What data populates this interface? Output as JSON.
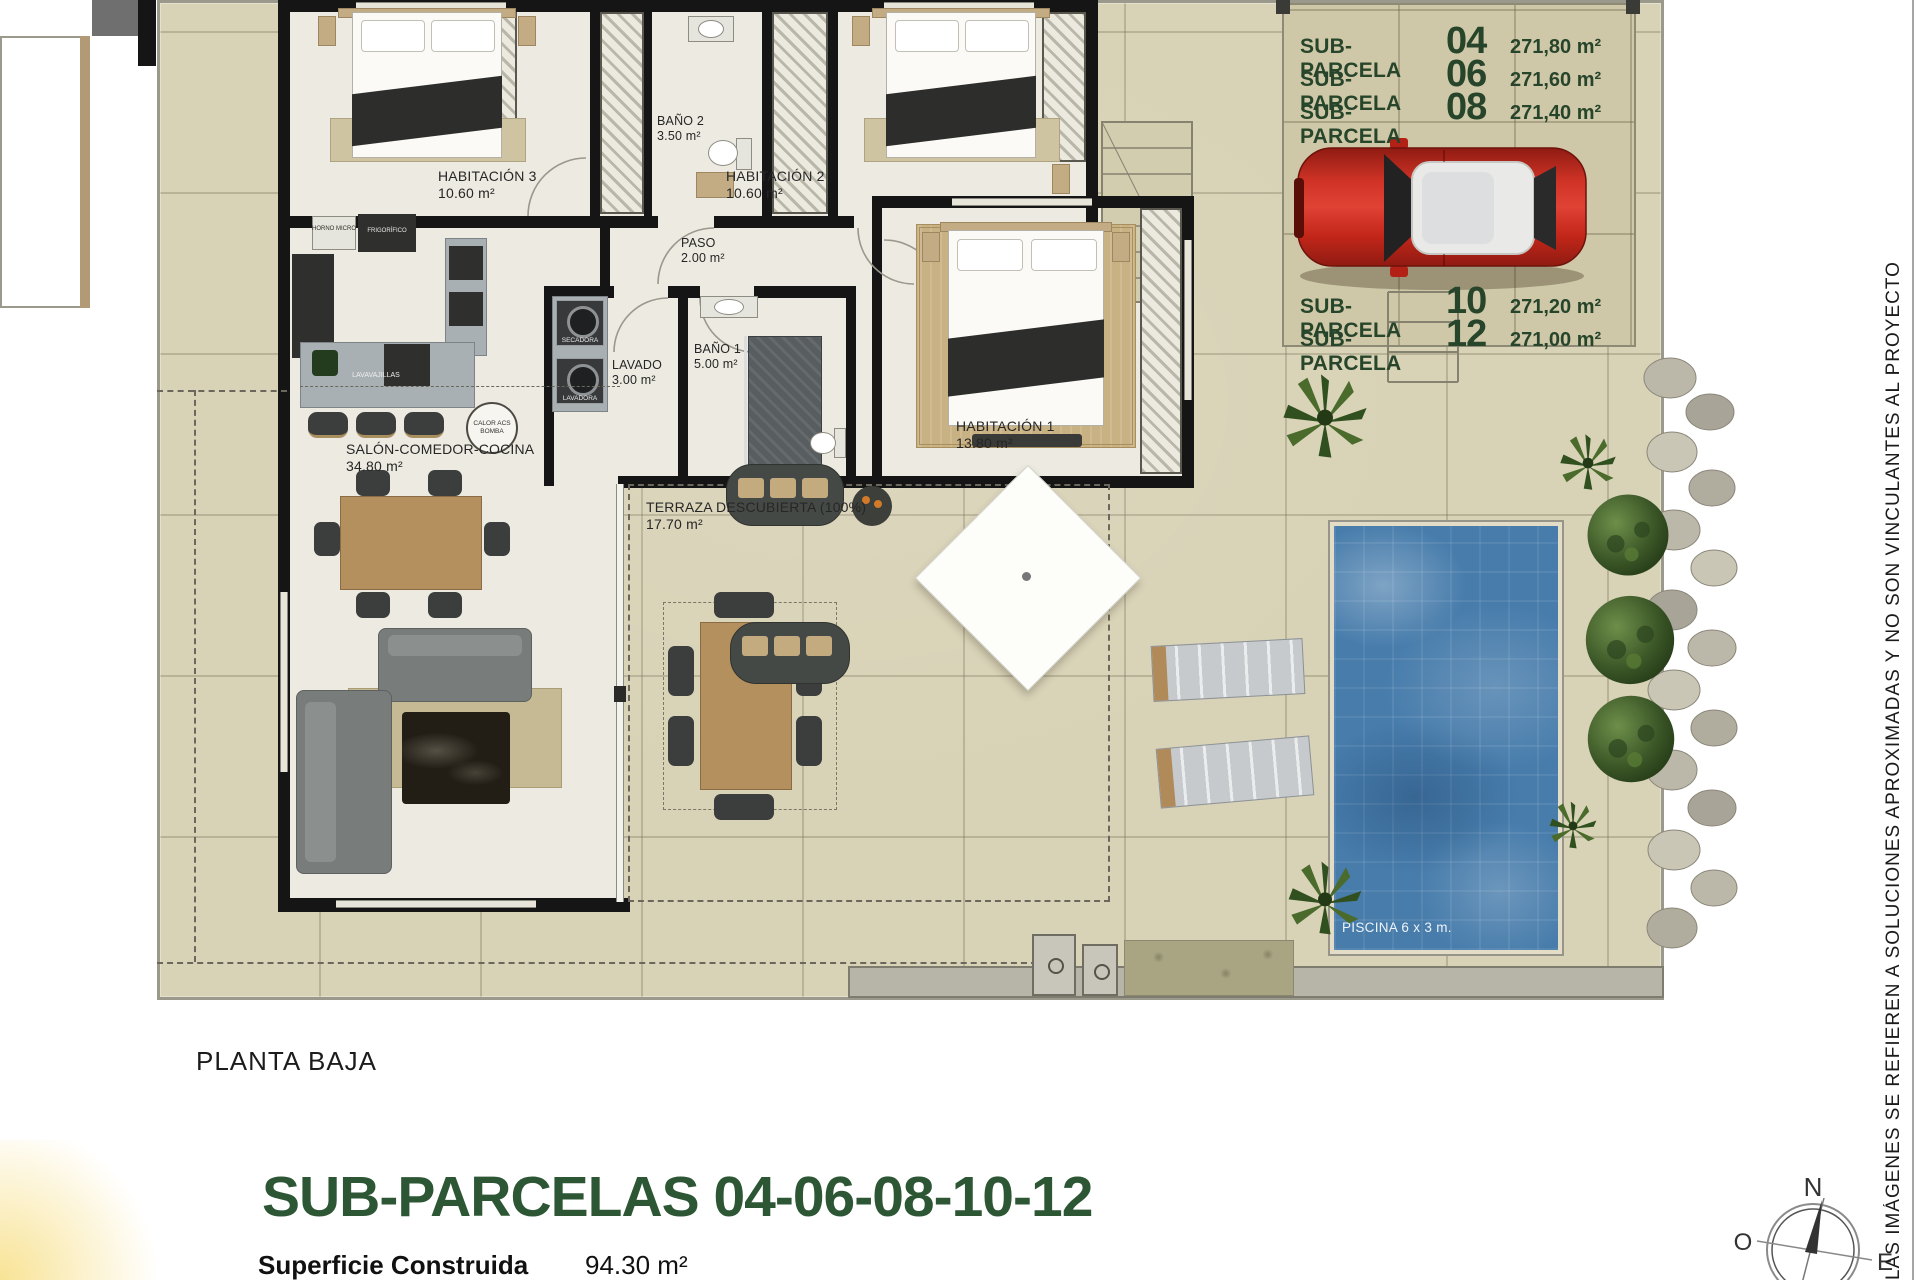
{
  "sub_parcelas": [
    {
      "label": "SUB-PARCELA",
      "num": "04",
      "area": "271,80 m²"
    },
    {
      "label": "SUB-PARCELA",
      "num": "06",
      "area": "271,60 m²"
    },
    {
      "label": "SUB-PARCELA",
      "num": "08",
      "area": "271,40 m²"
    },
    {
      "label": "SUB-PARCELA",
      "num": "10",
      "area": "271,20 m²"
    },
    {
      "label": "SUB-PARCELA",
      "num": "12",
      "area": "271,00 m²"
    }
  ],
  "rooms": {
    "habitacion3": {
      "name": "HABITACIÓN 3",
      "area": "10.60 m²"
    },
    "bano2": {
      "name": "BAÑO 2",
      "area": "3.50 m²"
    },
    "habitacion2": {
      "name": "HABITACIÓN 2",
      "area": "10.60 m²"
    },
    "paso": {
      "name": "PASO",
      "area": "2.00 m²"
    },
    "lavado": {
      "name": "LAVADO",
      "area": "3.00 m²"
    },
    "bano1": {
      "name": "BAÑO 1",
      "area": "5.00 m²"
    },
    "habitacion1": {
      "name": "HABITACIÓN 1",
      "area": "13.80 m²"
    },
    "salon": {
      "name": "SALÓN-COMEDOR-COCINA",
      "area": "34.80 m²"
    },
    "terraza": {
      "name": "TERRAZA DESCUBIERTA (100%)",
      "area": "17.70 m²"
    },
    "piscina": {
      "label": "PISCINA 6 x 3 m."
    }
  },
  "labels": {
    "secadora": "SECADORA",
    "lavadora": "LAVADORA",
    "lavavajillas": "LAVAVAJILLAS",
    "horno": "HORNO MICRO",
    "frigorifico": "FRIGORÍFICO",
    "calor1": "CALOR ACS",
    "calor2": "BOMBA"
  },
  "footer": {
    "plan": "PLANTA BAJA",
    "title": "SUB-PARCELAS 04-06-08-10-12",
    "surface_label": "Superficie Construida",
    "surface_value": "94.30 m²"
  },
  "disclaimer": "LAS IMÁGENES SE REFIEREN A SOLUCIONES APROXIMADAS Y NO SON VINCULANTES AL PROYECTO",
  "compass": {
    "n": "N",
    "o": "O",
    "e": "E"
  },
  "colors": {
    "accent_green": "#2c5634",
    "site_beige": "#d8d2b6",
    "pool_blue": "#477cab",
    "car_red": "#c4281e"
  }
}
